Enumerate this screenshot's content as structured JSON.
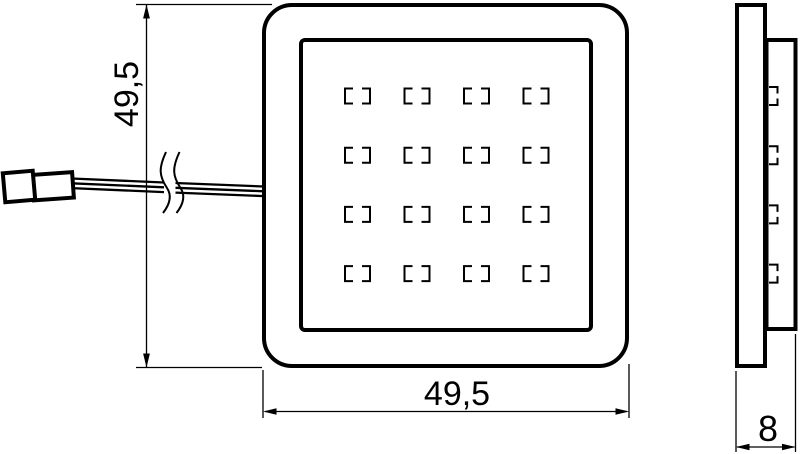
{
  "dimensions": {
    "height": "49,5",
    "width": "49,5",
    "depth": "8"
  },
  "front_view": {
    "led_rows": 4,
    "led_cols": 4
  },
  "side_view": {
    "led_rows": 4
  },
  "colors": {
    "line": "#000000",
    "background": "#ffffff"
  }
}
